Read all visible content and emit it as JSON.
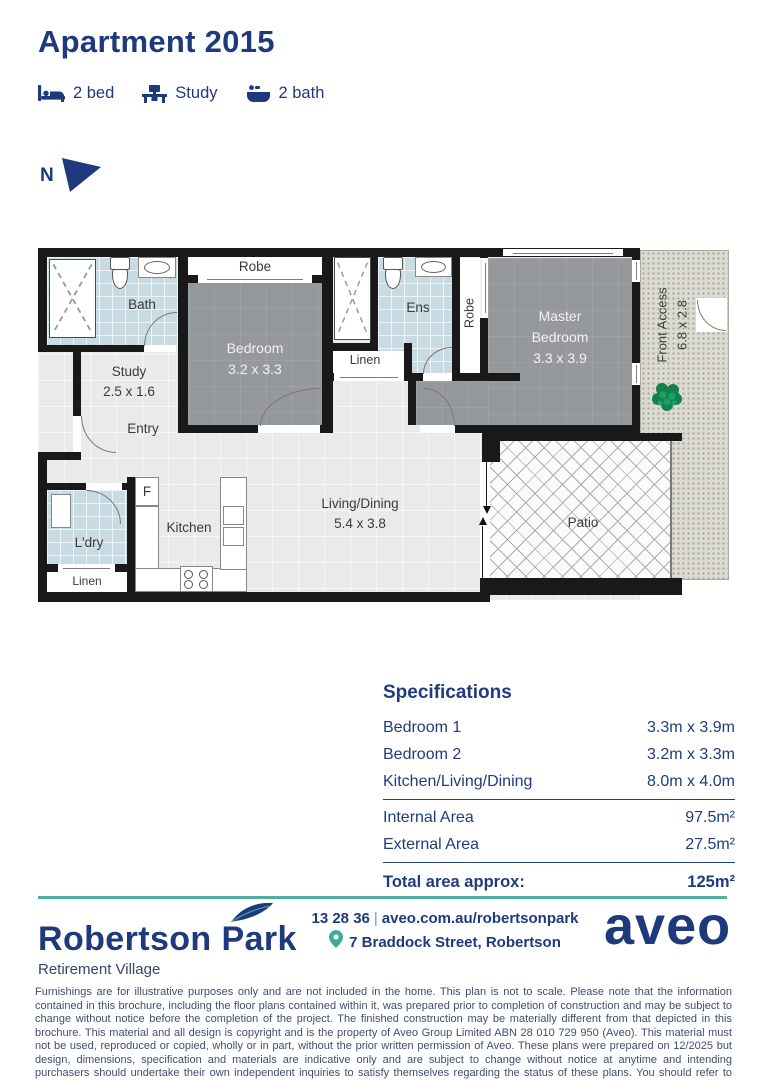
{
  "page": {
    "title": "Apartment 2015"
  },
  "features": [
    {
      "icon": "bed-icon",
      "label": "2 bed"
    },
    {
      "icon": "desk-icon",
      "label": "Study"
    },
    {
      "icon": "bath-icon",
      "label": "2 bath"
    }
  ],
  "compass": {
    "label": "N"
  },
  "plan": {
    "rooms": {
      "bath": "Bath",
      "robe_bedroom2": "Robe",
      "bedroom2": [
        "Bedroom",
        "3.2 x 3.3"
      ],
      "ens": "Ens",
      "robe_master": "Robe",
      "master": [
        "Master",
        "Bedroom",
        "3.3 x 3.9"
      ],
      "front_access": [
        "Front Access",
        "6.8 x 2.8"
      ],
      "study": [
        "Study",
        "2.5 x 1.6"
      ],
      "entry": "Entry",
      "linen_hall": "Linen",
      "living": [
        "Living/Dining",
        "5.4 x 3.8"
      ],
      "patio": "Patio",
      "kitchen": "Kitchen",
      "fridge": "F",
      "laundry": "L'dry",
      "linen_laundry": "Linen"
    }
  },
  "specifications": {
    "title": "Specifications",
    "rooms": [
      {
        "label": "Bedroom 1",
        "value": "3.3m x 3.9m"
      },
      {
        "label": "Bedroom 2",
        "value": "3.2m x 3.3m"
      },
      {
        "label": "Kitchen/Living/Dining",
        "value": "8.0m x 4.0m"
      }
    ],
    "areas": [
      {
        "label": "Internal Area",
        "value": "97.5m²"
      },
      {
        "label": "External Area",
        "value": "27.5m²"
      }
    ],
    "total": {
      "label": "Total area approx:",
      "value": "125m²"
    }
  },
  "footer": {
    "brand": "Robertson Park",
    "brand_subtitle": "Retirement Village",
    "phone": "13 28 36",
    "separator": "|",
    "website": "aveo.com.au/robertsonpark",
    "address": "7 Braddock Street, Robertson",
    "logo_text": "aveo"
  },
  "disclaimer": "Furnishings are for illustrative purposes only and are not included in the home. This plan is not to scale. Please note that the information contained in this brochure, including the floor plans contained within it, was prepared prior to completion of construction and may be subject to change without notice before the completion of the project. The finished construction may be materially different from that depicted in this brochure. This material and all design is copyright and is the property of Aveo Group Limited ABN 28 010 729 950 (Aveo). This material must not be used, reproduced or copied, wholly or in part, without the prior written permission of Aveo. These plans were prepared on 12/2025 but design, dimensions, specification and materials are indicative only and are subject to change without notice at anytime and intending purchasers should undertake their own independent inquiries to satisfy themselves regarding the status of these plans. You should refer to appropriate Survey Plans for confirmation of individual unit areas.",
  "colors": {
    "navy": "#1e3a7c",
    "teal": "#4fae9d"
  }
}
